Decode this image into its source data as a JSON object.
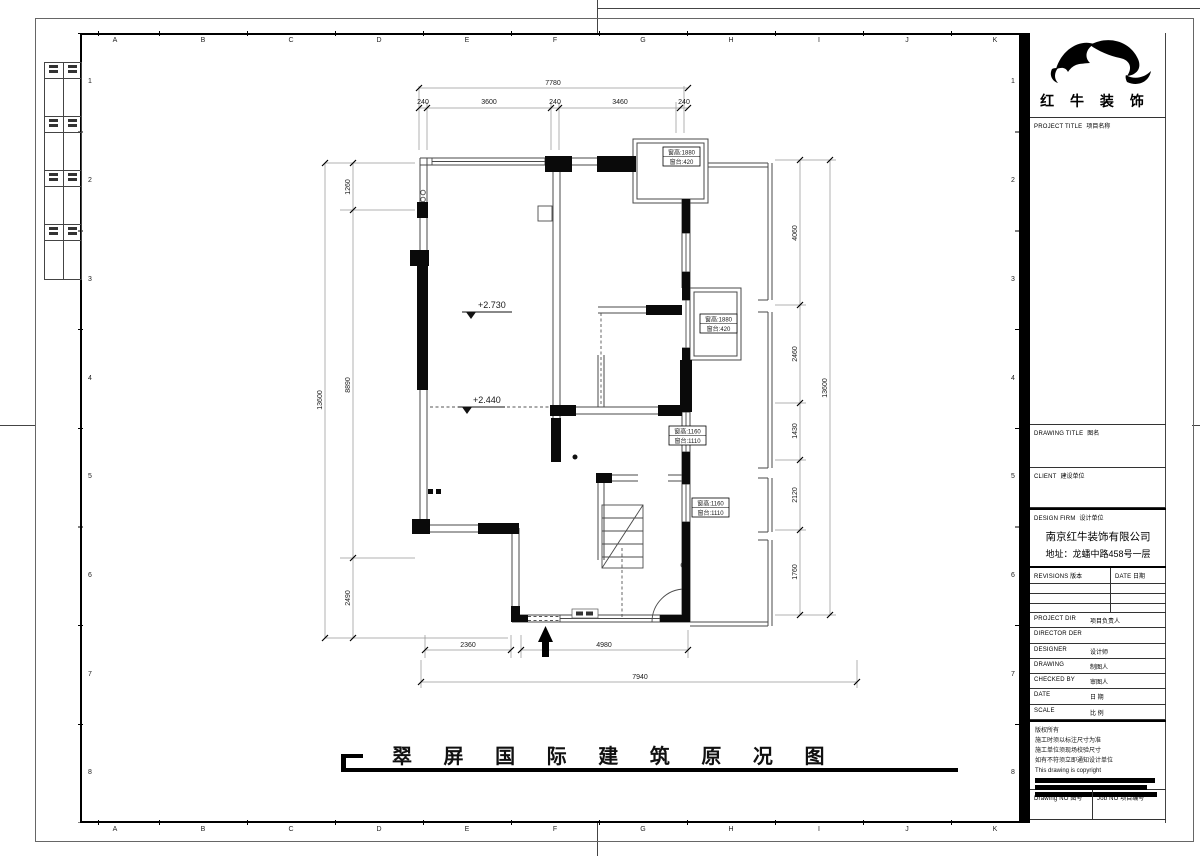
{
  "sheet": {
    "grid_letters": [
      "A",
      "B",
      "C",
      "D",
      "E",
      "F",
      "G",
      "H",
      "I",
      "J",
      "K"
    ],
    "grid_numbers": [
      "1",
      "2",
      "3",
      "4",
      "5",
      "6",
      "7",
      "8"
    ]
  },
  "brand": {
    "name": "红 牛 装 饰"
  },
  "title_block": {
    "project_title_en": "PROJECT TITLE",
    "project_title_zh": "项目名称",
    "drawing_title_en": "DRAWING TITLE",
    "drawing_title_zh": "图名",
    "client_en": "CLIENT",
    "client_zh": "建设单位",
    "design_firm_en": "DESIGN FIRM",
    "design_firm_zh": "设计单位",
    "design_firm_company": "南京红牛装饰有限公司",
    "design_firm_address": "地址：龙蟠中路458号一层",
    "revisions_en": "REVISIONS",
    "revisions_zh": "版本",
    "date_col_en": "DATE",
    "date_col_zh": "日期",
    "project_dir_en": "PROJECT DIR",
    "project_dir_zh": "项目负责人",
    "director_en": "DIRECTOR DER",
    "director_zh": "",
    "designer_en": "DESIGNER",
    "designer_zh": "设计师",
    "drawing_en": "DRAWING",
    "drawing_zh": "制图人",
    "checked_en": "CHECKED BY",
    "checked_zh": "审图人",
    "date_en": "DATE",
    "date_zh": "日 期",
    "scale_en": "SCALE",
    "scale_zh": "比 例",
    "notes": [
      "版权所有",
      "施工时须以标注尺寸为准",
      "施工单位须现场校验尺寸",
      "如有不符须立即通知设计单位",
      "This drawing is copyright"
    ],
    "drawing_no_en": "Drawing NO",
    "drawing_no_zh": "图号",
    "job_no_en": "Job NO",
    "job_no_zh": "项目编号"
  },
  "plan": {
    "title": "翠 屏 国 际 建 筑 原 况 图",
    "level_upper": "+2.730",
    "level_lower": "+2.440",
    "window_tags": [
      {
        "l1": "窗高:1880",
        "l2": "窗台:420"
      },
      {
        "l1": "窗高:1880",
        "l2": "窗台:420"
      },
      {
        "l1": "窗高:1160",
        "l2": "窗台:1110"
      },
      {
        "l1": "窗高:1160",
        "l2": "窗台:1110"
      }
    ],
    "dims": {
      "top_total": "7780",
      "top_segs": [
        "240",
        "3600",
        "240",
        "3460",
        "240"
      ],
      "left_total": "13600",
      "left_segs": [
        "1260",
        "8890",
        "2490"
      ],
      "right_total": "13600",
      "right_segs": [
        "4060",
        "2460",
        "1430",
        "2120",
        "1760"
      ],
      "bottom_total": "7940",
      "bottom_segs": [
        "2360",
        "4980"
      ]
    }
  }
}
